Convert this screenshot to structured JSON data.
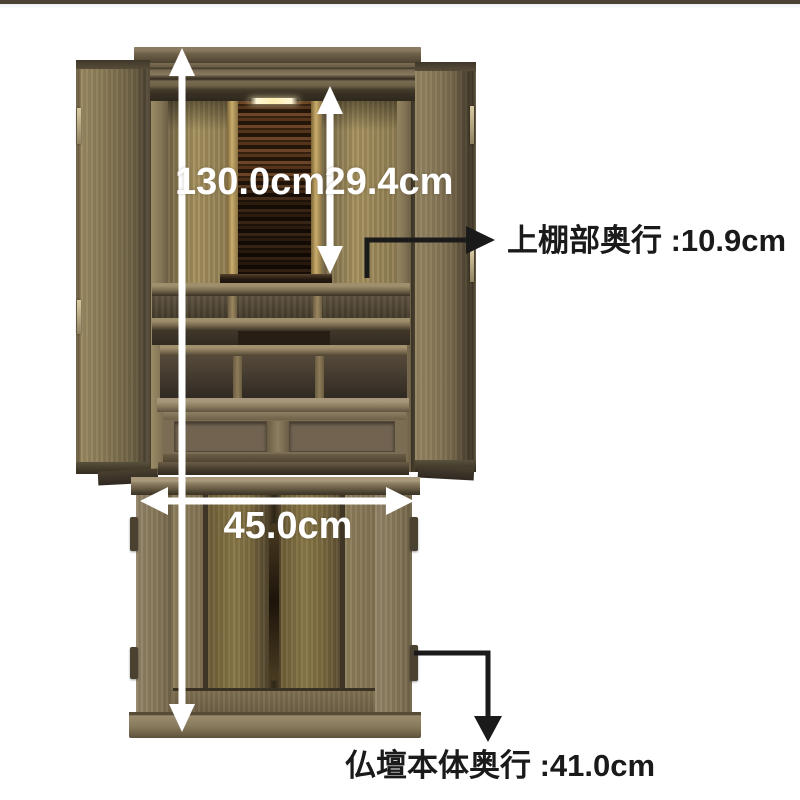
{
  "top_bar": {
    "color": "#4b4334"
  },
  "annotations": {
    "total_height": {
      "label": "130.0cm"
    },
    "upper_inner_height": {
      "label": "29.4cm"
    },
    "lower_width": {
      "label": "45.0cm"
    },
    "upper_shelf_depth": {
      "label": "上棚部奥行 :10.9cm"
    },
    "body_depth": {
      "label": "仏壇本体奥行 :41.0cm"
    }
  },
  "palette": {
    "background": "#ffffff",
    "top_bar": "#4b4334",
    "arrow_white": "#ffffff",
    "arrow_black": "#1a1a1a",
    "wood_light": "#9a8a62",
    "wood_mid": "#7e6f4e",
    "wood_dark": "#3d3526",
    "interior_tan": "#a6925f",
    "pillar_gold": "#c9ad6d",
    "ebony_light": "#6b4526",
    "ebony_dark": "#241509",
    "lower_door": "#7c6e4e"
  }
}
